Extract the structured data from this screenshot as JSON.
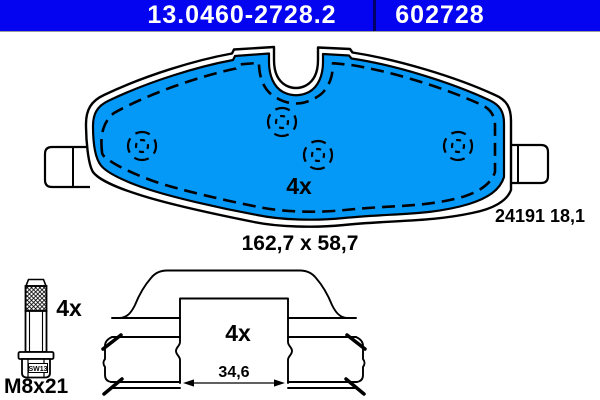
{
  "header": {
    "catalog_number": "13.0460-2728.2",
    "article_number": "602728"
  },
  "colors": {
    "header_bg": "#0404F0",
    "header_divider": "#000066",
    "header_text": "#FFFFFF",
    "pad_fill": "#0599F7",
    "line": "#000000"
  },
  "pad": {
    "quantity": "4x",
    "dimensions": "162,7 x 58,7",
    "wva_thickness": "24191 18,1"
  },
  "bolt": {
    "quantity": "4x",
    "thread": "M8x21",
    "wrench_size": "SW13"
  },
  "clip": {
    "quantity": "4x",
    "inner_width": "34,6"
  }
}
